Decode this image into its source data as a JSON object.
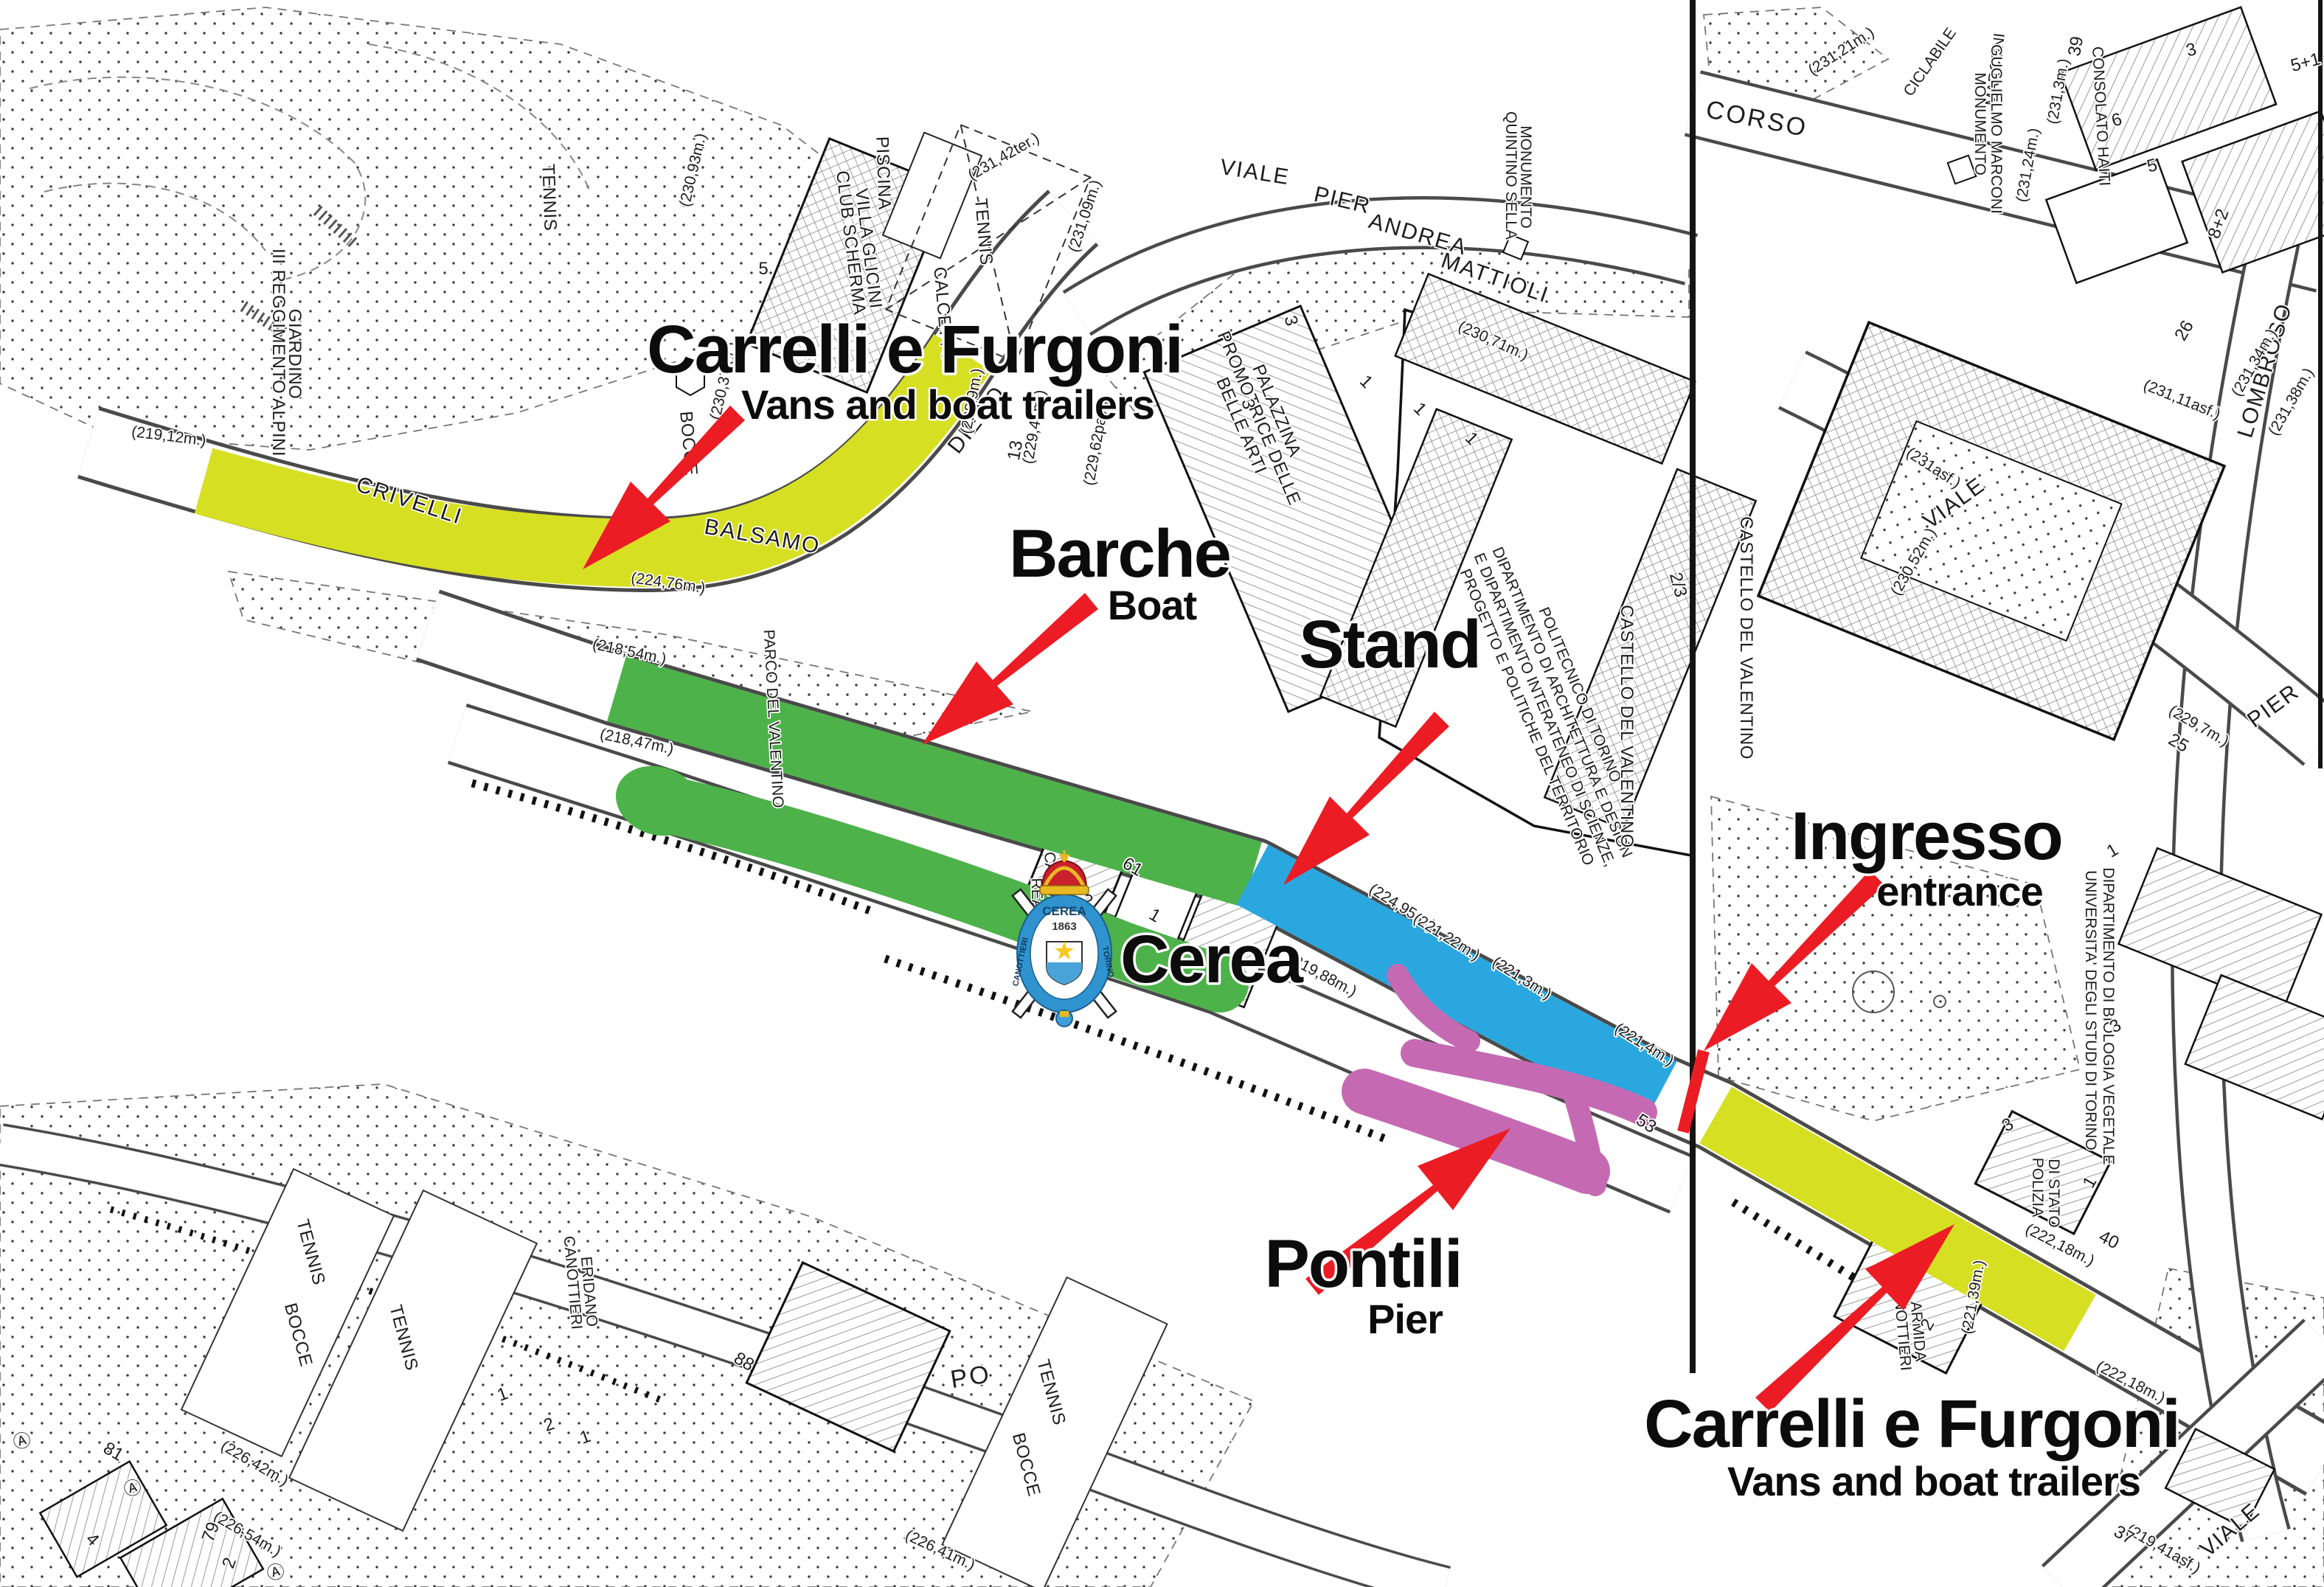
{
  "colors": {
    "zone_yellow": "#d7df23",
    "zone_green": "#4db24a",
    "zone_blue": "#2ba7df",
    "zone_purple": "#c56ab2",
    "arrow_red": "#ec1c24",
    "map_line": "#3a3a3a"
  },
  "annotations": {
    "carrelli_top": {
      "title": "Carrelli e Furgoni",
      "subtitle": "Vans and boat trailers"
    },
    "barche": {
      "title": "Barche",
      "subtitle": "Boat"
    },
    "stand": {
      "title": "Stand"
    },
    "cerea": {
      "title": "Cerea"
    },
    "ingresso": {
      "title": "Ingresso",
      "subtitle": "entrance"
    },
    "pontili": {
      "title": "Pontili",
      "subtitle": "Pier"
    },
    "carrelli_bottom": {
      "title": "Carrelli e Furgoni",
      "subtitle": "Vans and boat trailers"
    }
  },
  "crest": {
    "club": "CEREA",
    "year": "1863",
    "ring_left": "CANOTTIERI",
    "ring_right": "TORINO",
    "star": "★"
  },
  "streets": [
    "CRIVELLI",
    "BALSAMO",
    "DIEGO",
    "VIALE",
    "PIER",
    "ANDREA",
    "MATTIOLI",
    "CORSO",
    "LOMBROSO",
    "VIALE",
    "PIER",
    "PO",
    "VIALE",
    "CICLABILE",
    "MARCONI"
  ],
  "places": [
    "GIARDINO",
    "III REGGIMENTO ALPINI",
    "PISCINA",
    "CLUB SCHERMA",
    "VILLA GLICINI",
    "TENNIS",
    "TENNIS",
    "CALCETTO",
    "BOCCE",
    "PALAZZINA",
    "PROMOTRICE DELLE",
    "BELLE ARTI",
    "MONUMENTO",
    "QUINTINO SELLA",
    "POLITECNICO DI TORINO",
    "DIPARTIMENTO DI ARCHITETTURA E DESIGN",
    "E DIPARTIMENTO INTERATENEO DI SCIENZE,",
    "PROGETTO E POLITICHE DEL TERRITORIO",
    "CASTELLO DEL VALENTINO",
    "CASTELLO DEL VALENTINO",
    "PARCO DEL VALENTINO",
    "REALE S.",
    "CANOTTIERI CEREA",
    "MONUMENTO",
    "GUGLIELMO MARCONI",
    "CONSOLATO HAITI",
    "UNIVERSITA' DEGLI STUDI DI TORINO",
    "DIPARTIMENTO DI BIOLOGIA VEGETALE",
    "POLIZIA",
    "DI STATO",
    "CANOTTIERI",
    "ARMIDA",
    "TENNIS",
    "BOCCE",
    "TENNIS",
    "TENNIS",
    "BOCCE",
    "CANOTTIERI",
    "ERIDANO"
  ],
  "elevations": [
    "(219,12m.)",
    "(224,76m.)",
    "(230,93m.)",
    "(230,37ter.)",
    "(231,42ter.)",
    "(231,09m.)",
    "(228,9m.)",
    "(229,46m.)",
    "(229,62pav.)",
    "(230,71m.)",
    "(218,54m.)",
    "(218,47m.)",
    "(219,88m.)",
    "(224,95m.)",
    "(221,22m.)",
    "(221,3m.)",
    "(221,4m.)",
    "(231,21m.)",
    "(231,3m.)",
    "(231,24m.)",
    "(231,34m.)",
    "(231,38m.)",
    "(231asf.)",
    "(231,11asf.)",
    "(230,52m.)",
    "(229,7m.)",
    "(222,18m.)",
    "(222,18m.)",
    "(221,39m.)",
    "(219,41asf.)",
    "(226,42m.)",
    "(226,54m.)",
    "(226,41m.)"
  ],
  "numbers": [
    "5",
    "61",
    "1",
    "2",
    "2/3",
    "3",
    "3",
    "1",
    "1",
    "1",
    "3",
    "6",
    "5",
    "5+1",
    "8+2",
    "26",
    "39",
    "40",
    "37",
    "25",
    "88",
    "81",
    "79",
    "4",
    "2",
    "1",
    "2",
    "1",
    "2",
    "1",
    "1",
    "3",
    "3",
    "13",
    "53"
  ],
  "symbols": [
    "Ⓐ",
    "Ⓐ",
    "Ⓐ"
  ]
}
